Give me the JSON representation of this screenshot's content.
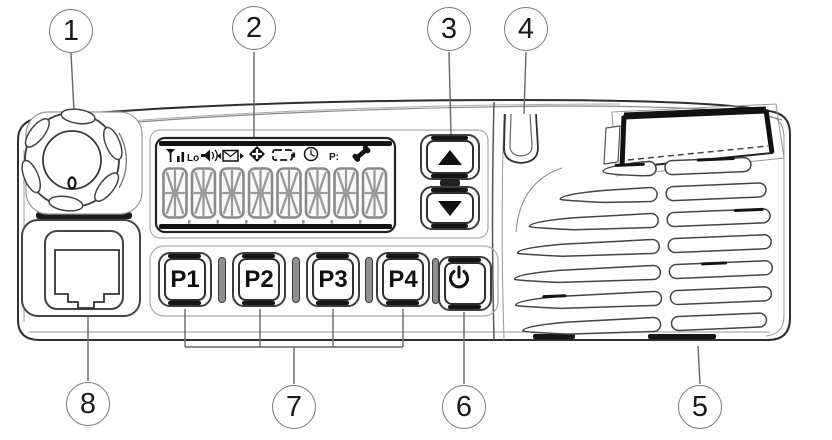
{
  "diagram": {
    "subject": "Mobile radio front panel numbered parts diagram",
    "callouts": [
      {
        "number": "1",
        "target": "channel-volume-knob"
      },
      {
        "number": "2",
        "target": "lcd-display"
      },
      {
        "number": "3",
        "target": "channel-up-down-buttons"
      },
      {
        "number": "4",
        "target": "led-indicator"
      },
      {
        "number": "5",
        "target": "speaker-grille"
      },
      {
        "number": "6",
        "target": "power-button"
      },
      {
        "number": "7",
        "target": "programmable-function-buttons"
      },
      {
        "number": "8",
        "target": "microphone-jack"
      }
    ]
  },
  "display": {
    "lo_label": "Lo",
    "priority_label": "P:",
    "digit_count": "8",
    "indicator_icons": [
      "signal-strength-icon",
      "low-power-label",
      "monitor-speaker-icon",
      "message-icon",
      "scan-icon",
      "battery-icon",
      "clock-icon",
      "priority-label",
      "call-icon"
    ]
  },
  "buttons": {
    "p1": "P1",
    "p2": "P2",
    "p3": "P3",
    "p4": "P4",
    "up_icon": "triangle-up",
    "down_icon": "triangle-down",
    "power_icon": "power-symbol"
  },
  "colors": {
    "line": "#3a3a3a",
    "accent_black": "#141414",
    "background": "#ffffff"
  }
}
